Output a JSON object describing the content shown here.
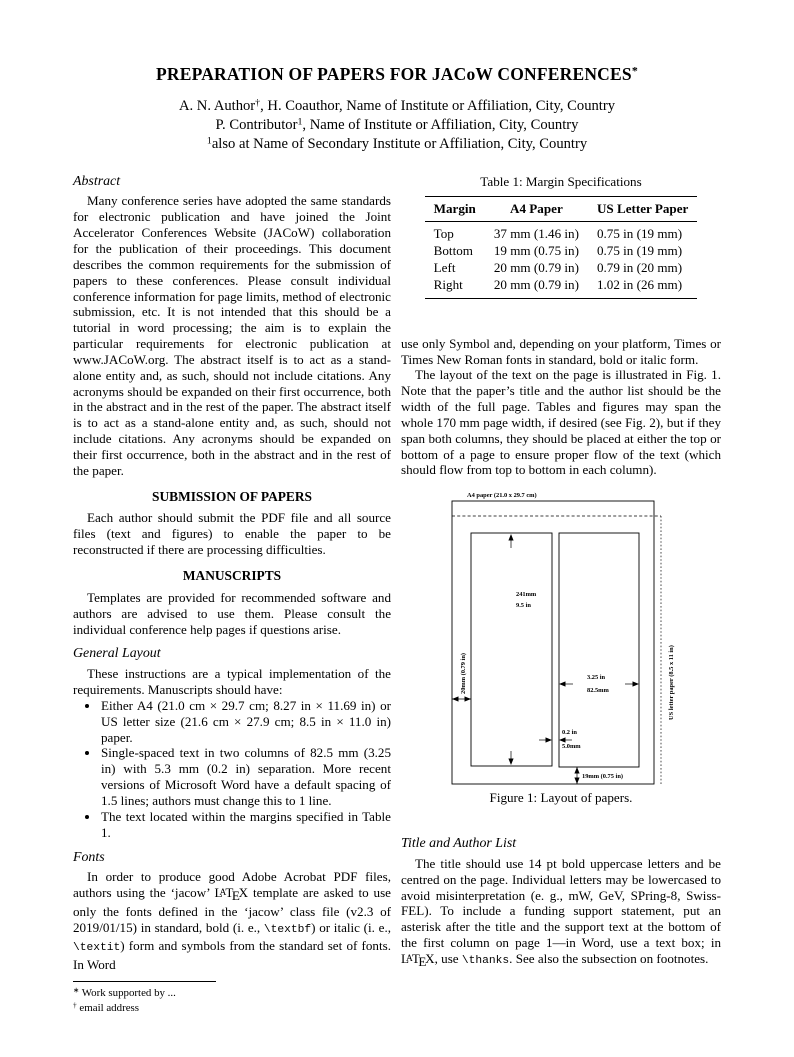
{
  "header": {
    "title": [
      {
        "t": "PREPARATION OF PAPERS FOR JACoW CONFERENCES"
      },
      {
        "t": "*",
        "s": "sup"
      }
    ],
    "authors": [
      [
        {
          "t": "A. N. Author"
        },
        {
          "t": "†",
          "s": "sup"
        },
        {
          "t": ", H. Coauthor, Name of Institute or Affiliation, City, Country"
        }
      ],
      [
        {
          "t": "P. Contributor"
        },
        {
          "t": "1",
          "s": "sup"
        },
        {
          "t": ", Name of Institute or Affiliation, City, Country"
        }
      ],
      [
        {
          "t": "1",
          "s": "sup"
        },
        {
          "t": "also at Name of Secondary Institute or Affiliation, City, Country"
        }
      ]
    ]
  },
  "left_column": {
    "abstract": {
      "heading": "Abstract",
      "body": "Many conference series have adopted the same standards for electronic publication and have joined the Joint Accelerator Conferences Website (JACoW) collaboration for the publication of their proceedings. This document describes the common requirements for the submission of papers to these conferences. Please consult individual conference information for page limits, method of electronic submission, etc. It is not intended that this should be a tutorial in word processing; the aim is to explain the particular requirements for electronic publication at www.JACoW.org. The abstract itself is to act as a stand-alone entity and, as such, should not include citations. Any acronyms should be expanded on their first occurrence, both in the abstract and in the rest of the paper. The abstract itself is to act as a stand-alone entity and, as such, should not include citations. Any acronyms should be expanded on their first occurrence, both in the abstract and in the rest of the paper."
    },
    "submission": {
      "heading": "SUBMISSION OF PAPERS",
      "body": "Each author should submit the PDF file and all source files (text and figures) to enable the paper to be reconstructed if there are processing difficulties."
    },
    "manuscripts": {
      "heading": "MANUSCRIPTS",
      "body": "Templates are provided for recommended software and authors are advised to use them. Please consult the individual conference help pages if questions arise."
    },
    "general_layout": {
      "heading": "General Layout",
      "intro": "These instructions are a typical implementation of the requirements. Manuscripts should have:",
      "bullets": [
        "Either A4 (21.0 cm × 29.7 cm; 8.27 in × 11.69 in) or US letter size (21.6 cm × 27.9 cm; 8.5 in × 11.0 in) paper.",
        "Single-spaced text in two columns of 82.5 mm (3.25 in) with 5.3 mm (0.2 in) separation. More recent versions of Microsoft Word have a default spacing of 1.5 lines; authors must change this to 1 line.",
        "The text located within the margins specified in Table 1."
      ]
    },
    "fonts": {
      "heading": "Fonts",
      "body": [
        {
          "t": "In order to produce good Adobe Acrobat PDF files, authors using the ‘jacow’ "
        },
        {
          "t": "LaTeX",
          "s": "latex"
        },
        {
          "t": " template are asked to use only the fonts defined in the ‘jacow’ class file (v2.3 of 2019/01/15) in standard, bold (i. e., "
        },
        {
          "t": "\\textbf",
          "s": "mono"
        },
        {
          "t": ") or italic (i. e., "
        },
        {
          "t": "\\textit",
          "s": "mono"
        },
        {
          "t": ") form and symbols from the standard set of fonts. In Word"
        }
      ]
    },
    "footnotes": [
      [
        {
          "t": "∗",
          "s": "sup"
        },
        {
          "t": " Work supported by ..."
        }
      ],
      [
        {
          "t": "†",
          "s": "sup"
        },
        {
          "t": " email address"
        }
      ]
    ]
  },
  "right_column": {
    "table": {
      "caption": "Table 1: Margin Specifications",
      "headers": [
        "Margin",
        "A4 Paper",
        "US Letter Paper"
      ],
      "rows": [
        [
          "Top",
          "37 mm (1.46 in)",
          "0.75 in (19 mm)"
        ],
        [
          "Bottom",
          "19 mm (0.75 in)",
          "0.75 in (19 mm)"
        ],
        [
          "Left",
          "20 mm (0.79 in)",
          "0.79 in (20 mm)"
        ],
        [
          "Right",
          "20 mm (0.79 in)",
          "1.02 in (26 mm)"
        ]
      ]
    },
    "para_continuation": "use only Symbol and, depending on your platform, Times or Times New Roman fonts in standard, bold or italic form.",
    "para_layout": "The layout of the text on the page is illustrated in Fig. 1. Note that the paper’s title and the author list should be the width of the full page. Tables and figures may span the whole 170 mm page width, if desired (see Fig. 2), but if they span both columns, they should be placed at either the top or bottom of a page to ensure proper flow of the text (which should flow from top to bottom in each column).",
    "figure": {
      "caption": "Figure 1: Layout of papers.",
      "labels": {
        "a4_paper": "A4 paper (21.0 x 29.7 cm)",
        "us_letter": "US letter paper (8.5 x 11 in)",
        "col_height_mm": "241mm",
        "col_height_in": "9.5 in",
        "left_margin": "20mm (0.79 in)",
        "col_width_in": "3.25 in",
        "col_width_mm": "82.5mm",
        "gap_in": "0.2 in",
        "gap_mm": "5.0mm",
        "bottom_margin": "19mm (0.75 in)"
      }
    },
    "title_author_list": {
      "heading": "Title and Author List",
      "body": [
        {
          "t": "The title should use 14 pt bold uppercase letters and be centred on the page. Individual letters may be lowercased to avoid misinterpretation (e. g., mW, GeV, SPring-8, Swiss-FEL). To include a funding support statement, put an asterisk after the title and the support text at the bottom of the first column on page 1—in Word, use a text box; in "
        },
        {
          "t": "LaTeX",
          "s": "latex"
        },
        {
          "t": ", use "
        },
        {
          "t": "\\thanks",
          "s": "mono"
        },
        {
          "t": ". See also the subsection on footnotes."
        }
      ]
    }
  }
}
